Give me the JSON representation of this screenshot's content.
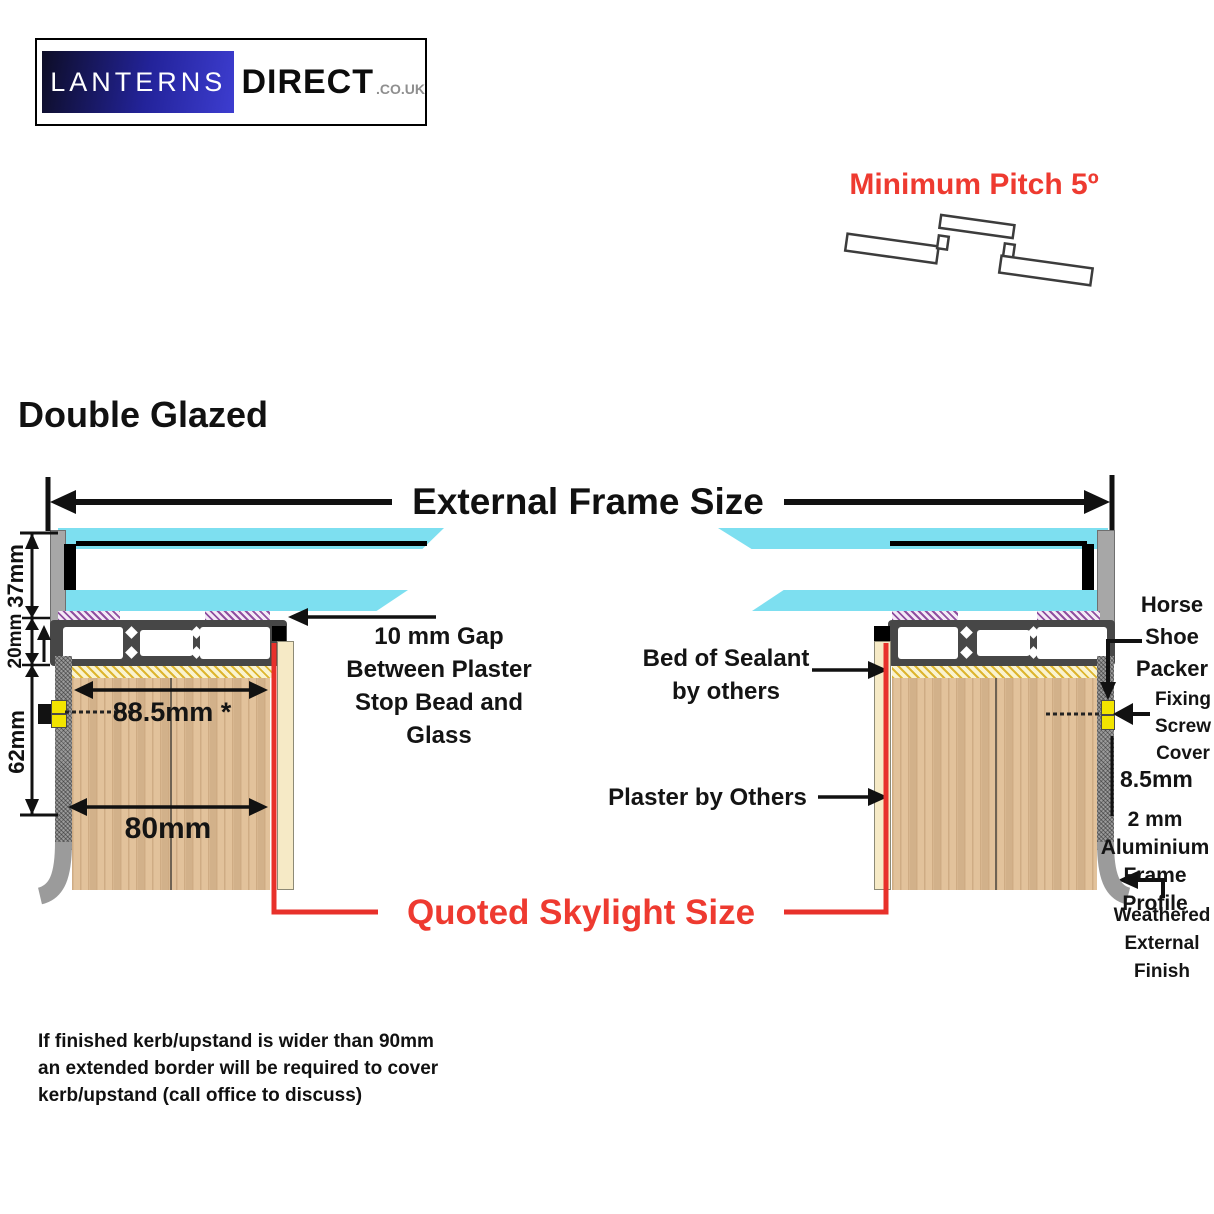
{
  "logo": {
    "primary": "LANTERNS",
    "secondary": "DIRECT",
    "tld": ".CO.UK"
  },
  "header": {
    "min_pitch": "Minimum Pitch 5º",
    "section_title": "Double Glazed"
  },
  "diagram": {
    "external_frame_label": "External Frame Size",
    "quoted_size_label": "Quoted Skylight Size",
    "dim_glass": "37mm",
    "dim_profile": "20mm",
    "dim_upstand_height": "62mm",
    "dim_upstand_width": "88.5mm *",
    "dim_inner_width": "80mm",
    "dim_cover": "8.5mm",
    "gap_note": [
      "10 mm Gap",
      "Between Plaster",
      "Stop Bead and",
      "Glass"
    ],
    "sealant_note": [
      "Bed of Sealant",
      "by others"
    ],
    "plaster_note": "Plaster by Others",
    "horse_shoe_note": [
      "Horse",
      "Shoe",
      "Packer"
    ],
    "fixing_screw_note": [
      "Fixing",
      "Screw",
      "Cover"
    ],
    "alu_profile_note": [
      "2 mm",
      "Aluminium",
      "Frame Profile"
    ],
    "weathered_note": [
      "Weathered",
      "External",
      "Finish"
    ]
  },
  "footer": {
    "lines": [
      "If finished kerb/upstand is wider than 90mm",
      "an extended border will be required to cover",
      "kerb/upstand (call office to discuss)"
    ]
  },
  "colors": {
    "accent_red": "#EE3A30",
    "glass_cyan": "#7DDFF0",
    "frame_grey": "#9B9B9B",
    "profile_dark": "#474747",
    "wood_tan": "#E2C29B",
    "sealant_yellow": "#F6ECC4",
    "gasket_purple": "#8E4FA0",
    "packer_yellow": "#F2E400",
    "plaster_cream": "#F6EAC6"
  }
}
